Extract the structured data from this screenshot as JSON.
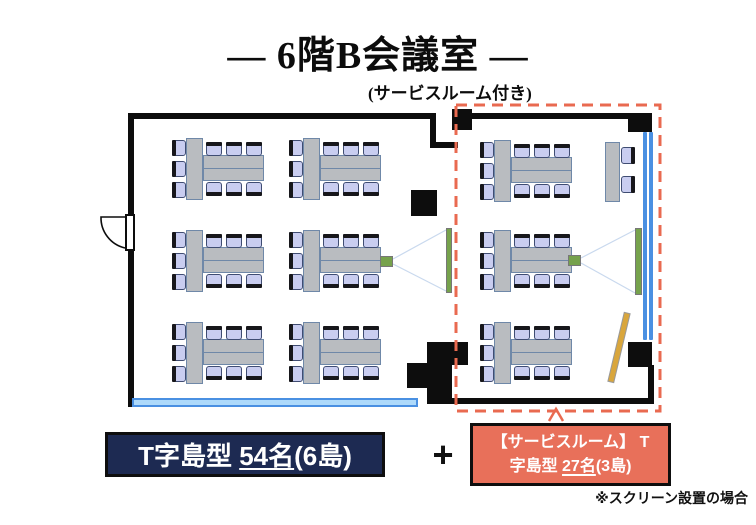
{
  "title": {
    "main": "― 6階B会議室 ―",
    "sub": "(サービスルーム付き)"
  },
  "legend": {
    "main_label": {
      "prefix": "T字島型 ",
      "count": "54名",
      "suffix": "(6島)"
    },
    "plus": "+",
    "service_label": {
      "line1": "【サービスルーム】 T",
      "line2_prefix": "字島型 ",
      "line2_count": "27名",
      "line2_suffix": "(3島)"
    },
    "note": "※スクリーン設置の場合"
  },
  "colors": {
    "wall": "#0d0d0d",
    "table_fill": "#b9bcc0",
    "table_border": "#6f88a8",
    "chair_fill": "#c9cdf0",
    "chair_border": "#3f4c72",
    "chair_back": "#17171b",
    "window_blue": "#4a90e2",
    "window_light": "#aedafb",
    "screen_green": "#76a24c",
    "beam": "#c9d9ee",
    "dashed_red": "#e96a50",
    "navy_box": "#1d2a52",
    "salmon_box": "#e8705a",
    "stick_yellow": "#d9a63c"
  },
  "floorplan": {
    "islands": [
      {
        "type": "t9",
        "x": 173,
        "y": 138
      },
      {
        "type": "t9",
        "x": 290,
        "y": 138
      },
      {
        "type": "t9",
        "x": 173,
        "y": 230
      },
      {
        "type": "t9",
        "x": 290,
        "y": 230
      },
      {
        "type": "t9",
        "x": 173,
        "y": 322
      },
      {
        "type": "t9",
        "x": 290,
        "y": 322
      },
      {
        "type": "t9",
        "x": 481,
        "y": 140
      },
      {
        "type": "t9",
        "x": 481,
        "y": 230
      },
      {
        "type": "t9",
        "x": 481,
        "y": 322
      },
      {
        "type": "side2",
        "x": 605,
        "y": 142
      }
    ],
    "screens": [
      {
        "x": 446,
        "y": 228,
        "w": 6,
        "h": 65
      },
      {
        "x": 635,
        "y": 228,
        "w": 7,
        "h": 67
      }
    ],
    "projectors": [
      {
        "x": 380,
        "y": 256,
        "w": 13,
        "h": 11
      },
      {
        "x": 568,
        "y": 255,
        "w": 13,
        "h": 11
      }
    ],
    "beams": [
      [
        393,
        259,
        446,
        230
      ],
      [
        393,
        264,
        446,
        291
      ],
      [
        581,
        258,
        635,
        230
      ],
      [
        581,
        263,
        635,
        293
      ]
    ],
    "pillars": [
      {
        "x": 411,
        "y": 190,
        "w": 26,
        "h": 26
      }
    ]
  }
}
